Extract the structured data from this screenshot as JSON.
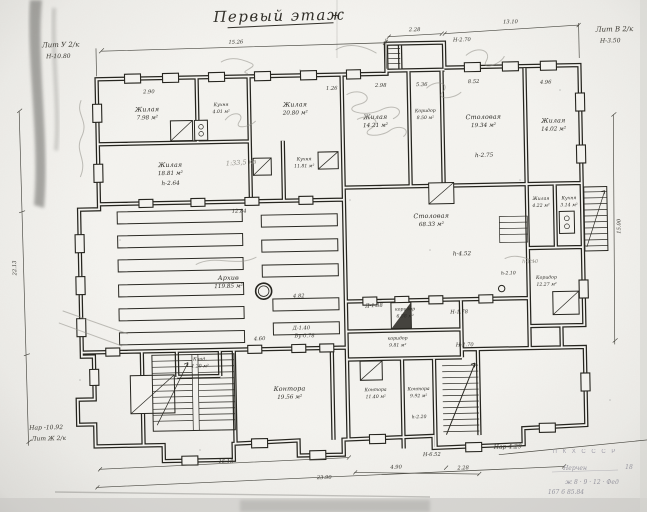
{
  "title": {
    "text": "Первый этаж"
  },
  "corner_labels": {
    "top_left_lit": "Лит У 2/к",
    "top_left_h": "Н-10.80",
    "top_right_lit": "Лит В 2/к",
    "top_right_h": "Н-3.50",
    "bottom_left_nar": "Нар -10.92",
    "bottom_left_lit": "Лит Ж 2/к",
    "bottom_right_nar": "Нар-4.29"
  },
  "rooms": [
    {
      "name": "Жилая",
      "area": "7.98 м²"
    },
    {
      "name": "Кухня",
      "area": "4.01 м²"
    },
    {
      "name": "Жилая",
      "area": "20.80 м²"
    },
    {
      "name": "Жилая",
      "area": "18.81 м²",
      "note": "h-2.64"
    },
    {
      "name": "Кухня",
      "area": "11.81 м²"
    },
    {
      "name": "Жилая",
      "area": "14.21 м²"
    },
    {
      "name": "Коридор",
      "area": "8.50 м²"
    },
    {
      "name": "Столовая",
      "area": "19.34 м²",
      "note": "h-2.75"
    },
    {
      "name": "Жилая",
      "area": "14.02 м²"
    },
    {
      "name": "Жилая",
      "area": "4.22 м²"
    },
    {
      "name": "Кухня",
      "area": "3.14 м²"
    },
    {
      "name": "Коридор",
      "area": "12.27 м²",
      "note": "h-2.10"
    },
    {
      "name": "Столовая",
      "area": "68.33 м²",
      "note": "h-4.52"
    },
    {
      "name": "Архив",
      "area": "119.85 м²"
    },
    {
      "name": "коридор",
      "area": "6.88 м²"
    },
    {
      "name": "коридор",
      "area": "9.81 м²"
    },
    {
      "name": "Клад.",
      "area": "1.20 м²"
    },
    {
      "name": "Контора",
      "area": "19.56 м²"
    },
    {
      "name": "Контора",
      "area": "11.40 м²"
    },
    {
      "name": "Контора",
      "area": "9.92 м²",
      "note": "h-2.20"
    }
  ],
  "dimensions": {
    "top_main": "15.26",
    "annex_width": "2.28",
    "top_right": "13.10",
    "annex_height": "Н-2.70",
    "left_vertical": "22.13",
    "right_vertical": "15.00",
    "bottom_1": "15.18",
    "bottom_2": "23.90",
    "bottom_3": "4.90",
    "bottom_4": "2.28",
    "bottom_5": "Н-6.52",
    "mid_height": "Н-2.70",
    "d1": "1.26",
    "d2": "2.98",
    "d3": "5.36",
    "d4": "8.52",
    "d5": "4.96",
    "d6": "12.84",
    "d7": "4.60",
    "d8": "2.90",
    "d9": "4.82",
    "d10": "Д-1.38",
    "d11": "Н-1.78",
    "d12": "Д-1.40",
    "d13": "Ву-0.78"
  },
  "annotations": {
    "pencil_scale": "1:33,5 кв",
    "pencil_h": "h-1.10"
  },
  "stamp": {
    "org": "П К Х   С С С Р",
    "city": "Нерчен",
    "num": "18",
    "hand1": "ж 8 · 9 · 12 · Фед",
    "hand2": "167  6  85.84"
  }
}
